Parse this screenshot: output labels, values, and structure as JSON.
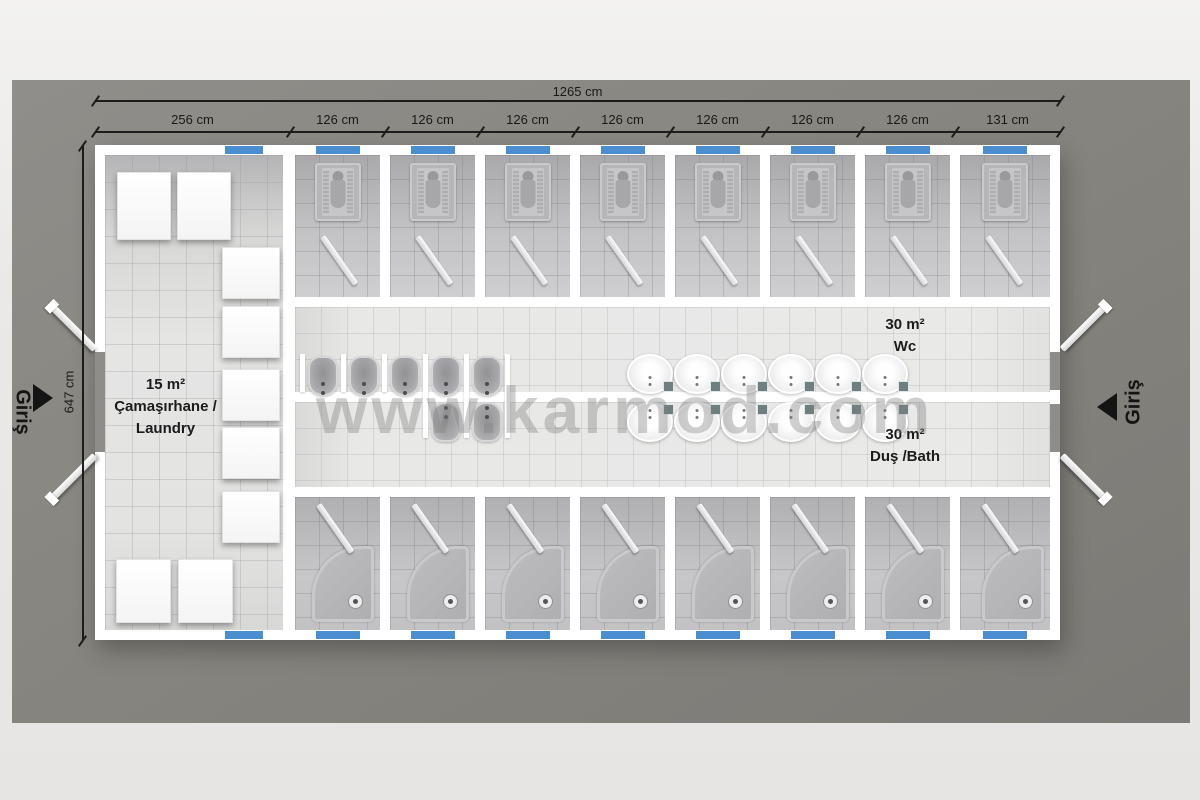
{
  "watermark": "www.karmod.com",
  "dimensions": {
    "total": "1265 cm",
    "segments": [
      "256 cm",
      "126 cm",
      "126 cm",
      "126 cm",
      "126 cm",
      "126 cm",
      "126 cm",
      "126 cm",
      "131 cm"
    ],
    "height": "647 cm"
  },
  "entrances": {
    "left": "Giriş",
    "right": "Giriş"
  },
  "rooms": {
    "laundry": {
      "area": "15 m²",
      "name_tr": "Çamaşırhane /",
      "name_en": "Laundry"
    },
    "wc": {
      "area": "30 m²",
      "name": "Wc"
    },
    "bath": {
      "area": "30 m²",
      "name": "Duş /Bath"
    }
  },
  "colors": {
    "window_blue": "#4a8ecf",
    "wall_white": "#ffffff",
    "ground_gray": "#86847f"
  },
  "fixtures": {
    "squat_toilet_stalls": 8,
    "shower_stalls": 8,
    "urinals_wc_side": 5,
    "urinals_bath_side": 2,
    "washbasin_pairs": 6,
    "washing_machines": 9
  }
}
